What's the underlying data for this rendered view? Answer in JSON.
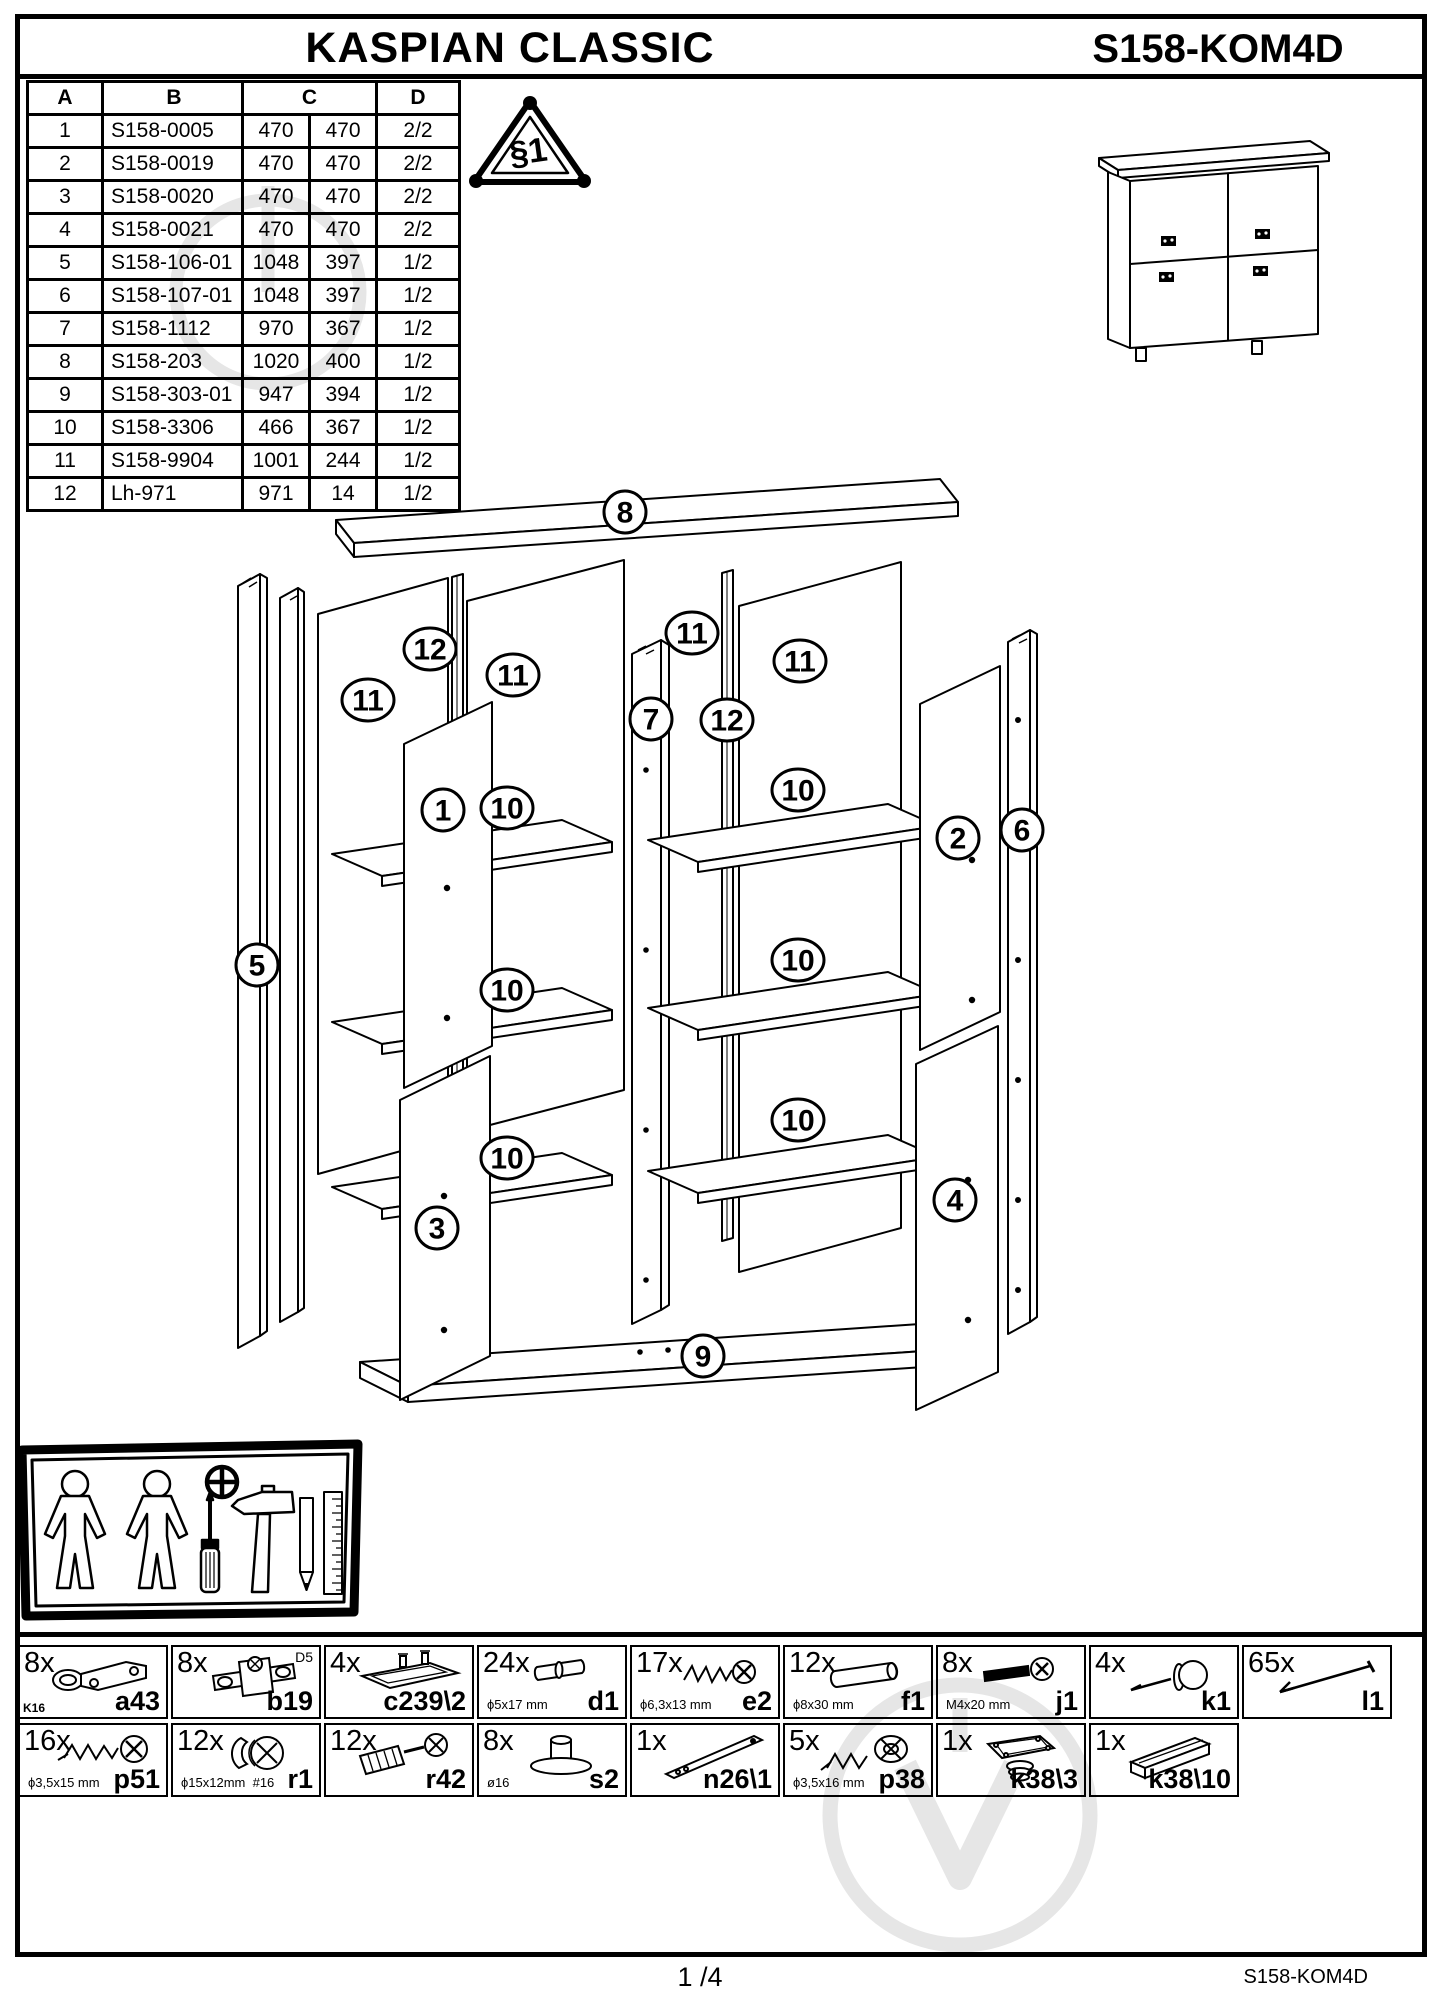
{
  "header": {
    "title": "KASPIAN CLASSIC",
    "model": "S158-KOM4D"
  },
  "safety_triangle": {
    "label": "§1"
  },
  "parts_table": {
    "col_headers": [
      "A",
      "B",
      "C",
      "D"
    ],
    "rows": [
      {
        "a": "1",
        "b": "S158-0005",
        "c1": "470",
        "c2": "470",
        "d": "2/2"
      },
      {
        "a": "2",
        "b": "S158-0019",
        "c1": "470",
        "c2": "470",
        "d": "2/2"
      },
      {
        "a": "3",
        "b": "S158-0020",
        "c1": "470",
        "c2": "470",
        "d": "2/2"
      },
      {
        "a": "4",
        "b": "S158-0021",
        "c1": "470",
        "c2": "470",
        "d": "2/2"
      },
      {
        "a": "5",
        "b": "S158-106-01",
        "c1": "1048",
        "c2": "397",
        "d": "1/2"
      },
      {
        "a": "6",
        "b": "S158-107-01",
        "c1": "1048",
        "c2": "397",
        "d": "1/2"
      },
      {
        "a": "7",
        "b": "S158-1112",
        "c1": "970",
        "c2": "367",
        "d": "1/2"
      },
      {
        "a": "8",
        "b": "S158-203",
        "c1": "1020",
        "c2": "400",
        "d": "1/2"
      },
      {
        "a": "9",
        "b": "S158-303-01",
        "c1": "947",
        "c2": "394",
        "d": "1/2"
      },
      {
        "a": "10",
        "b": "S158-3306",
        "c1": "466",
        "c2": "367",
        "d": "1/2"
      },
      {
        "a": "11",
        "b": "S158-9904",
        "c1": "1001",
        "c2": "244",
        "d": "1/2"
      },
      {
        "a": "12",
        "b": "Lh-971",
        "c1": "971",
        "c2": "14",
        "d": "1/2"
      }
    ]
  },
  "diagram": {
    "callouts": [
      {
        "n": "8",
        "x": 625,
        "y": 512
      },
      {
        "n": "12",
        "x": 430,
        "y": 649
      },
      {
        "n": "11",
        "x": 368,
        "y": 700
      },
      {
        "n": "11",
        "x": 513,
        "y": 675
      },
      {
        "n": "11",
        "x": 692,
        "y": 633
      },
      {
        "n": "7",
        "x": 651,
        "y": 719
      },
      {
        "n": "12",
        "x": 727,
        "y": 720
      },
      {
        "n": "11",
        "x": 800,
        "y": 661
      },
      {
        "n": "1",
        "x": 443,
        "y": 810
      },
      {
        "n": "10",
        "x": 507,
        "y": 808
      },
      {
        "n": "10",
        "x": 798,
        "y": 790
      },
      {
        "n": "2",
        "x": 958,
        "y": 838
      },
      {
        "n": "6",
        "x": 1022,
        "y": 830
      },
      {
        "n": "5",
        "x": 257,
        "y": 965
      },
      {
        "n": "10",
        "x": 507,
        "y": 990
      },
      {
        "n": "10",
        "x": 798,
        "y": 960
      },
      {
        "n": "10",
        "x": 507,
        "y": 1158
      },
      {
        "n": "10",
        "x": 798,
        "y": 1120
      },
      {
        "n": "3",
        "x": 437,
        "y": 1228
      },
      {
        "n": "4",
        "x": 955,
        "y": 1200
      },
      {
        "n": "9",
        "x": 703,
        "y": 1356
      }
    ]
  },
  "hardware": {
    "items": [
      {
        "qty": "8x",
        "code": "a43",
        "dim": "",
        "note": "K16"
      },
      {
        "qty": "8x",
        "code": "b19",
        "dim": "",
        "note": "D5"
      },
      {
        "qty": "4x",
        "code": "c239\\2",
        "dim": "",
        "note": ""
      },
      {
        "qty": "24x",
        "code": "d1",
        "dim": "ϕ5x17 mm",
        "note": ""
      },
      {
        "qty": "17x",
        "code": "e2",
        "dim": "ϕ6,3x13 mm",
        "note": ""
      },
      {
        "qty": "12x",
        "code": "f1",
        "dim": "ϕ8x30 mm",
        "note": ""
      },
      {
        "qty": "8x",
        "code": "j1",
        "dim": "M4x20 mm",
        "note": ""
      },
      {
        "qty": "4x",
        "code": "k1",
        "dim": "",
        "note": ""
      },
      {
        "qty": "65x",
        "code": "l1",
        "dim": "",
        "note": ""
      },
      {
        "qty": "16x",
        "code": "p51",
        "dim": "ϕ3,5x15 mm",
        "note": ""
      },
      {
        "qty": "12x",
        "code": "r1",
        "dim": "ϕ15x12mm  #16",
        "note": ""
      },
      {
        "qty": "12x",
        "code": "r42",
        "dim": "",
        "note": ""
      },
      {
        "qty": "8x",
        "code": "s2",
        "dim": "ø16",
        "note": ""
      },
      {
        "qty": "1x",
        "code": "n26\\1",
        "dim": "",
        "note": ""
      },
      {
        "qty": "5x",
        "code": "p38",
        "dim": "ϕ3,5x16 mm",
        "note": ""
      },
      {
        "qty": "1x",
        "code": "k38\\3",
        "dim": "",
        "note": ""
      },
      {
        "qty": "1x",
        "code": "k38\\10",
        "dim": "",
        "note": ""
      }
    ]
  },
  "footer": {
    "page": "1 /4",
    "model": "S158-KOM4D"
  }
}
